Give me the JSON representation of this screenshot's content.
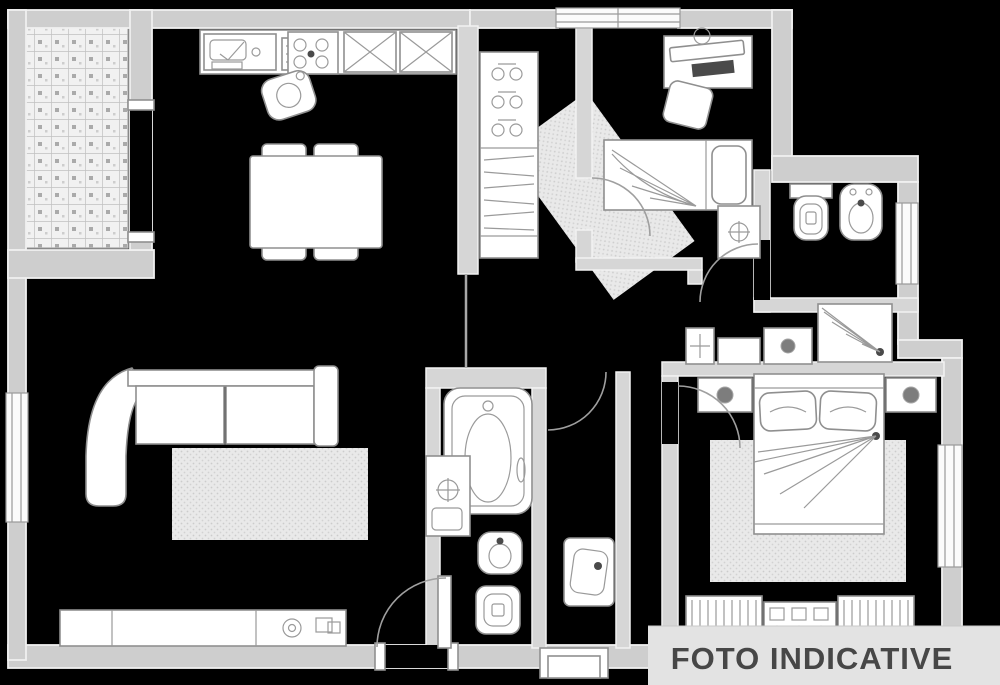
{
  "watermark": {
    "text": "FOTO INDICATIVE"
  },
  "palette": {
    "background": "#000000",
    "wall_fill": "#cecece",
    "inner_wall_fill": "#d6d6d6",
    "wall_edge": "#f0f0f0",
    "furniture_fill": "#ffffff",
    "line": "#8f8f8f",
    "rug_fill": "#e9e9e9",
    "rug_dot": "#cccccc",
    "tile_fill": "#f1f1f1",
    "tile_line": "#c0c0c0",
    "watermark_bg": "#e3e3e3",
    "watermark_text": "#474747",
    "dark_item": "#4a4a4a"
  },
  "plan": {
    "type": "apartment-floor-plan",
    "rooms": [
      {
        "name": "terrace",
        "features": [
          "tiled-floor",
          "door-to-kitchen"
        ]
      },
      {
        "name": "kitchen",
        "features": [
          "sink",
          "drainboard",
          "cooktop-4-burners",
          "tall-cabinets",
          "stool",
          "dining-table",
          "chairs-4"
        ]
      },
      {
        "name": "living-room",
        "features": [
          "corner-sofa",
          "rug",
          "sideboard",
          "entry-door",
          "window-left",
          "threshold-step"
        ]
      },
      {
        "name": "hallway",
        "features": [
          "wardrobe-hangers",
          "wardrobe-shelves",
          "runner-rug"
        ]
      },
      {
        "name": "bedroom-small",
        "features": [
          "desk",
          "chair",
          "single-bed",
          "nightstand-lamp",
          "window-top",
          "rug"
        ]
      },
      {
        "name": "bathroom-top",
        "features": [
          "toilet",
          "bidet",
          "wall-unit",
          "window-right",
          "door"
        ]
      },
      {
        "name": "dressing-area",
        "features": [
          "duct-column",
          "bench",
          "nightstand-lamp",
          "shower"
        ]
      },
      {
        "name": "bathroom-main",
        "features": [
          "bathtub",
          "washbasin-vanity",
          "bidet",
          "toilet",
          "door"
        ]
      },
      {
        "name": "wc-laundry",
        "features": [
          "washbasin-unit",
          "threshold-step"
        ]
      },
      {
        "name": "bedroom-master",
        "features": [
          "double-bed",
          "pillows-2",
          "nightstands-2",
          "rug",
          "radiators-3",
          "window-right",
          "door"
        ]
      }
    ]
  }
}
